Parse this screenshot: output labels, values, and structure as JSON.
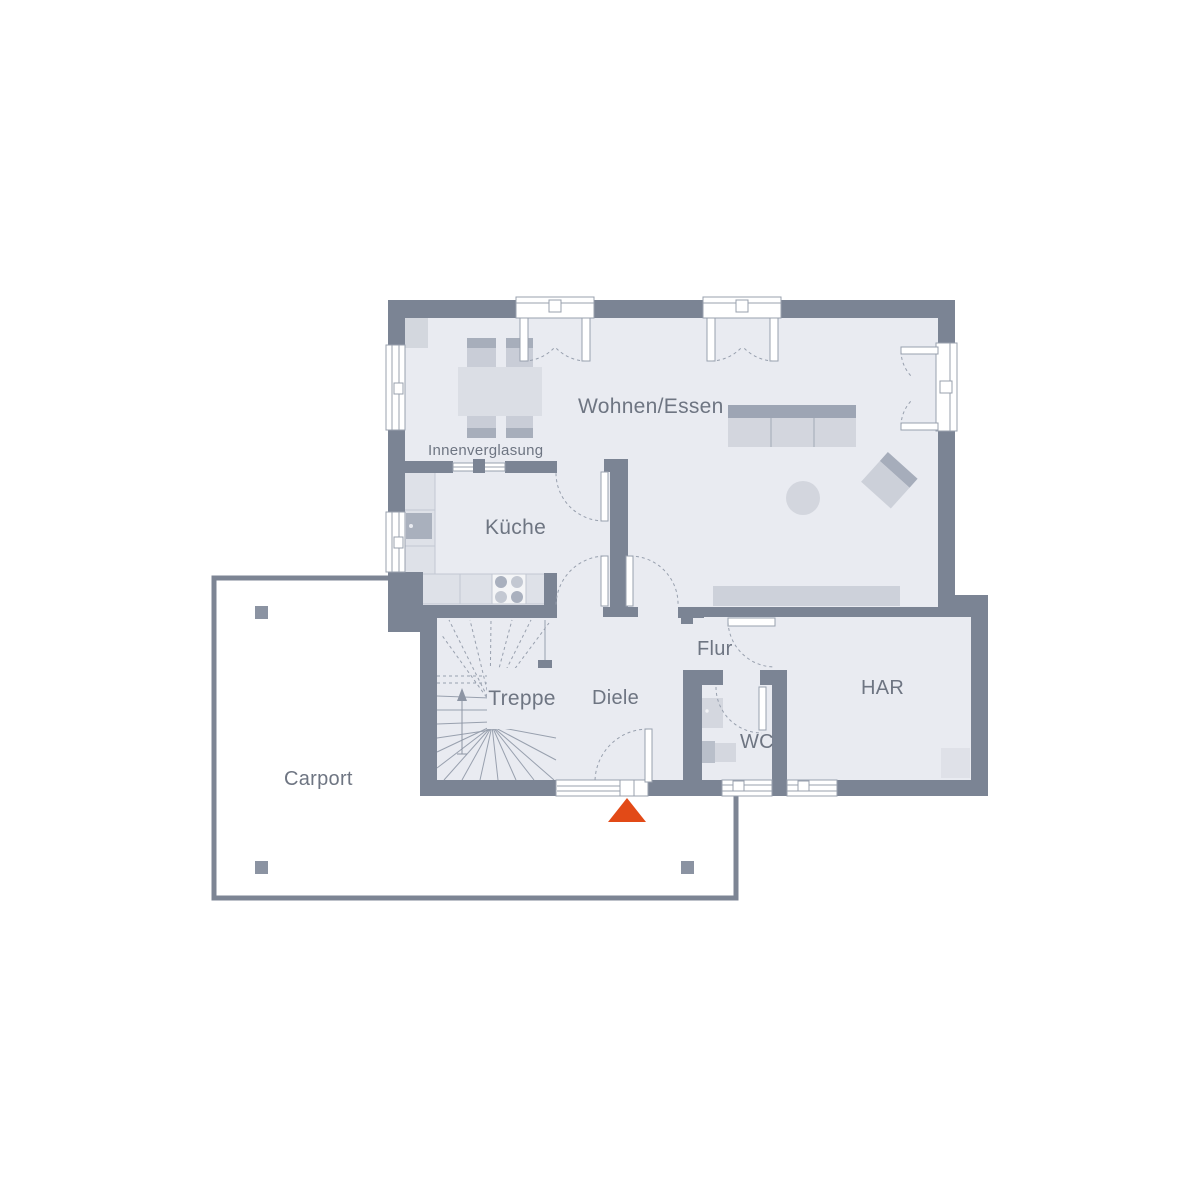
{
  "plan": {
    "labels": {
      "wohnen_essen": "Wohnen/Essen",
      "innenverglasung": "Innenverglasung",
      "kueche": "Küche",
      "treppe": "Treppe",
      "diele": "Diele",
      "flur": "Flur",
      "wc": "WC",
      "har": "HAR",
      "carport": "Carport"
    },
    "colors": {
      "wall": "#7b8494",
      "room_fill": "#e9ebf1",
      "carport_border": "#7d8594",
      "carport_post": "#8b93a2",
      "furniture_light": "#d3d6de",
      "furniture_mid": "#c9cdd7",
      "furniture_dark": "#a2a9b7",
      "counter_fill": "#dee1e8",
      "appliance_dark": "#a9b0bd",
      "line": "#98a0ae",
      "label_text": "#6e7582",
      "entrance_marker": "#e24a17",
      "background": "#ffffff"
    },
    "entrance": {
      "marker_shape": "triangle-up"
    }
  }
}
